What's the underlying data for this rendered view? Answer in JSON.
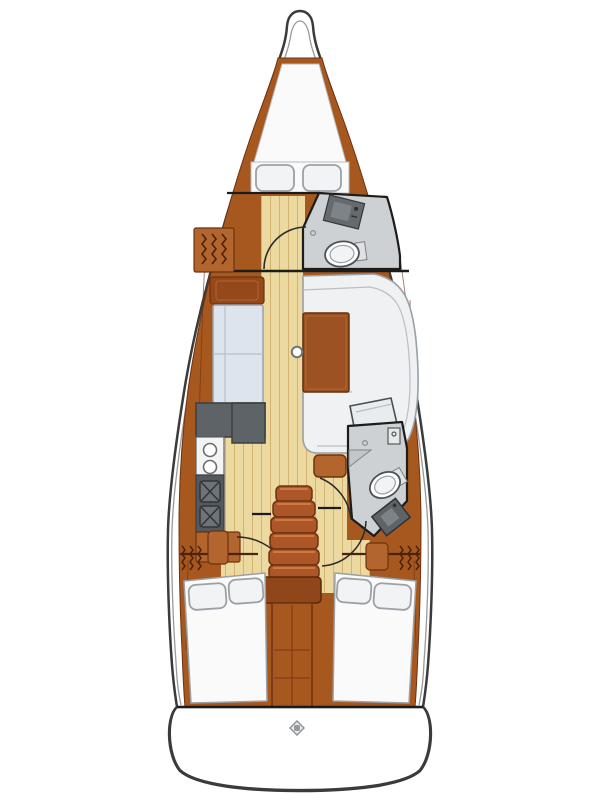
{
  "diagram": {
    "type": "sailboat-interior-floor-plan",
    "orientation": "bow-up",
    "areas": [
      "v-berth",
      "forward-cabin",
      "forward-head",
      "saloon",
      "galley",
      "navigation-table",
      "companionway-stairs",
      "aft-head",
      "aft-cabin-port",
      "aft-cabin-starboard",
      "swim-platform"
    ]
  },
  "colors": {
    "background": "#ffffff",
    "hull_white": "#ffffff",
    "outline": "#3b3b3b",
    "deck_line": "#9a9a9a",
    "wood": "#a6581f",
    "wood_light": "#b2652c",
    "wood_dark": "#6e3212",
    "floor": "#ecd9a0",
    "floor_line": "#d3b272",
    "head_floor": "#cdd1d3",
    "head_wall": "#1c1c1c",
    "fixture_gray": "#646a6e",
    "fixture_dark": "#5d6367",
    "fixture_light": "#7d8387",
    "sofa_port": "#dde4ed",
    "sofa_starboard": "#eff1f3",
    "upholstery_line": "#b9bfc5",
    "upholstery_stroke": "#99a0a7",
    "table_wood": "#9c5222",
    "table_stroke": "#66320e",
    "stair_wood": "#ad5628",
    "stair_highlight": "#d78a52",
    "stair_dark": "#8f4719",
    "bed_white": "#fafafa",
    "bed_stroke": "#9aa0a6",
    "pillow": "#f2f3f4",
    "pillow_stroke": "#9ba1a7",
    "counter_dark": "#5d6367",
    "counter_stroke": "#3a3f42",
    "sink_basin": "#6d7377",
    "stove_white": "#f4f4f4",
    "toilet_white": "#ffffff",
    "toilet_stroke": "#4c5257",
    "emblem_gray": "#8a9094",
    "shelf_wood": "#95491b"
  }
}
